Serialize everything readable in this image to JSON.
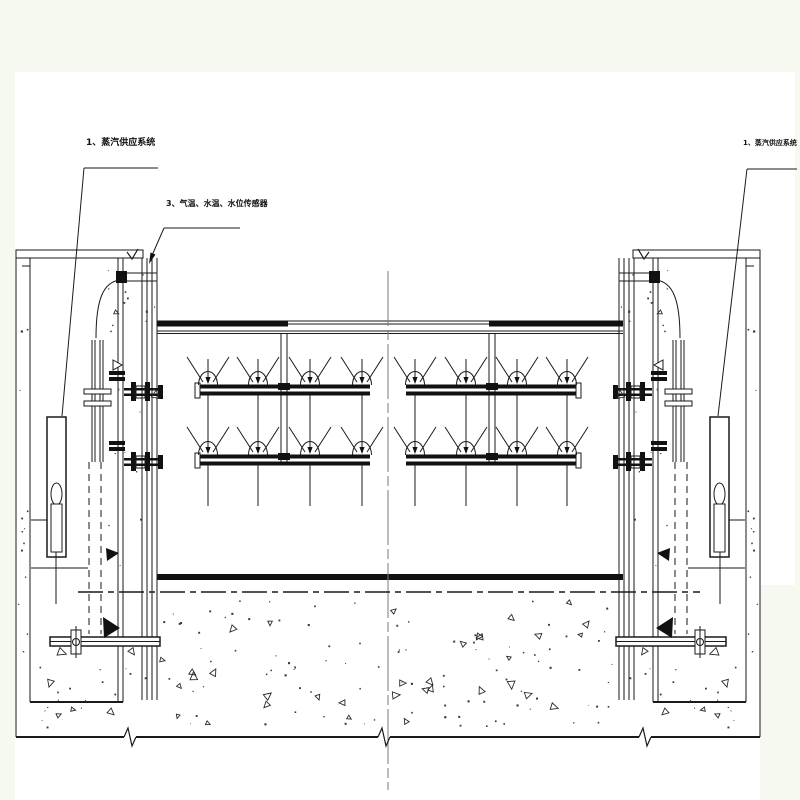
{
  "drawing": {
    "type": "engineering-section-drawing",
    "labels": {
      "steam_system_left": "1、蒸汽供应系统",
      "sensors": "3、气温、水温、水位传感器",
      "steam_system_right": "1、蒸汽供应系统"
    },
    "symbols": {
      "rim_level_mark": "∨",
      "leader_arrow": "filled-arrowhead",
      "break_line": "zigzag",
      "concrete_texture": "aggregate-triangles-and-dots"
    },
    "colors": {
      "line": "#1a1a1a",
      "canvas": "#ffffff",
      "margin": "#f6f9f0",
      "centerline": "#7a7a7a"
    }
  }
}
